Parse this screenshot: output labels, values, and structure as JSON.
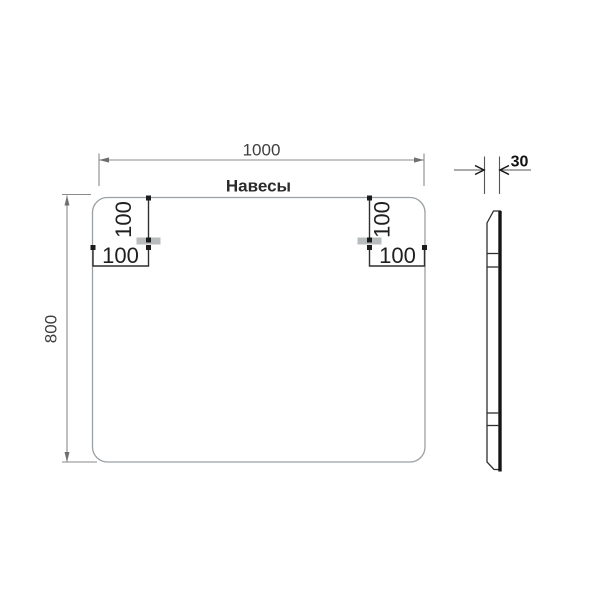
{
  "drawing": {
    "labels": {
      "hangers": "Навесы",
      "width": "1000",
      "height": "800",
      "thickness": "30",
      "left_hanger_top_offset": "100",
      "left_hanger_side_offset": "100",
      "right_hanger_top_offset": "100",
      "right_hanger_side_offset": "100"
    },
    "dimensions_mm": {
      "width": 1000,
      "height": 800,
      "thickness": 30,
      "hanger_offset_from_top": 100,
      "hanger_offset_from_side": 100
    },
    "colors": {
      "outline": "#9aa0a4",
      "dimension_line": "#8a8a8a",
      "detail_line": "#2f2f2f",
      "text": "#1f1f1f",
      "bracket_fill": "#b9bcbe",
      "profile_edge": "#151515"
    }
  }
}
